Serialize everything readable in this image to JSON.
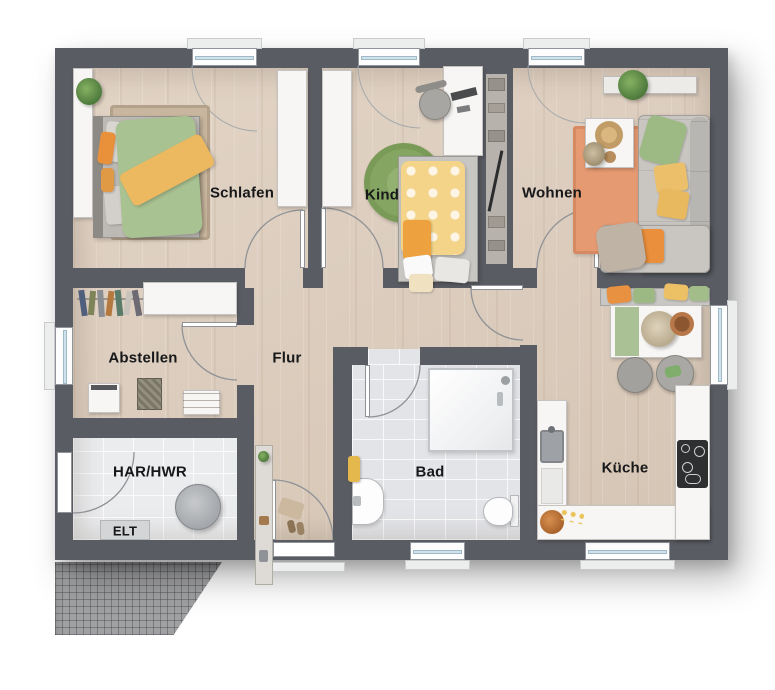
{
  "rooms": {
    "schlafen": {
      "label": "Schlafen"
    },
    "kind": {
      "label": "Kind"
    },
    "wohnen": {
      "label": "Wohnen"
    },
    "abstellen": {
      "label": "Abstellen"
    },
    "flur": {
      "label": "Flur"
    },
    "har_hwr": {
      "label": "HAR/HWR"
    },
    "elt": {
      "label": "ELT"
    },
    "bad": {
      "label": "Bad"
    },
    "kueche": {
      "label": "Küche"
    }
  },
  "colors": {
    "wall": "#595c62",
    "wood_floor": "#dccdbe",
    "bathroom_tile": "#e3e4e7",
    "utility_tile": "#ebecee",
    "terrace": "#a0a1a3",
    "accent_orange": "#e8913f",
    "accent_green": "#9cb883",
    "accent_yellow": "#ecc064",
    "furniture_white": "#f7f6f4",
    "sofa_gray": "#c6c4c0"
  }
}
